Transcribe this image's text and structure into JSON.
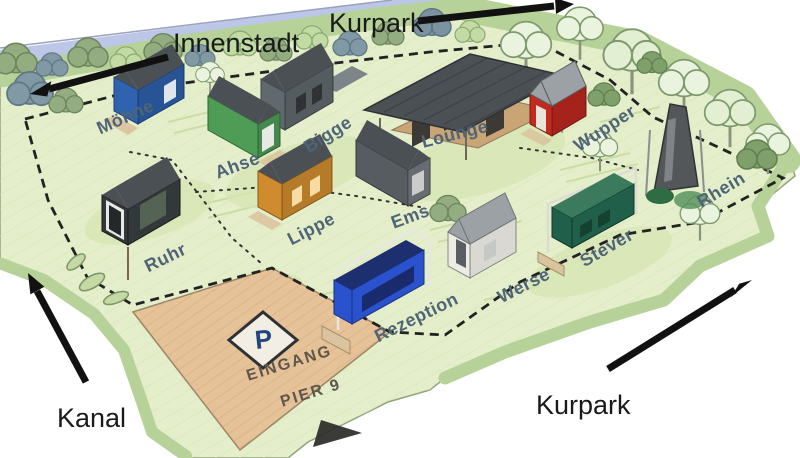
{
  "map": {
    "region_labels": {
      "innenstadt": "Innenstadt",
      "kurpark_top": "Kurpark",
      "kurpark_bottom": "Kurpark",
      "kanal": "Kanal"
    },
    "site_labels": {
      "moehne": "Möhne",
      "ruhr": "Ruhr",
      "ahse": "Ahse",
      "lippe": "Lippe",
      "bigge": "Bigge",
      "ems": "Ems",
      "lounge": "Lounge",
      "rezeption": "Rezeption",
      "werse": "Werse",
      "stever": "Stever",
      "wupper": "Wupper",
      "rhein": "Rhein"
    },
    "parking": {
      "sign": "P",
      "entrance_line1": "EINGANG",
      "entrance_line2": "PIER 9"
    },
    "colors": {
      "river": "#bcc7e8",
      "grass": "#e4eecb",
      "hedge": "#b7d298",
      "parking": "#e6c298",
      "label_text": "#4f6476",
      "region_text": "#1a1a1a",
      "parking_text": "#5d564b",
      "parking_p": "#23457d",
      "house_moehne": "#2f63b0",
      "house_ruhr": "#33383a",
      "house_ahse": "#4f9c57",
      "house_bigge": "#61696e",
      "house_lippe": "#cf8c2e",
      "house_ems": "#565c60",
      "house_wupper": "#c22a20",
      "house_werse": "#ecebe4",
      "house_stever": "#20604a",
      "house_rezeption": "#2a52cc",
      "lounge_wood": "#c9a475",
      "tower": "#53575a",
      "roof": "#4b5054",
      "roof_light": "#9ba1a5",
      "arrow": "#111111"
    }
  }
}
